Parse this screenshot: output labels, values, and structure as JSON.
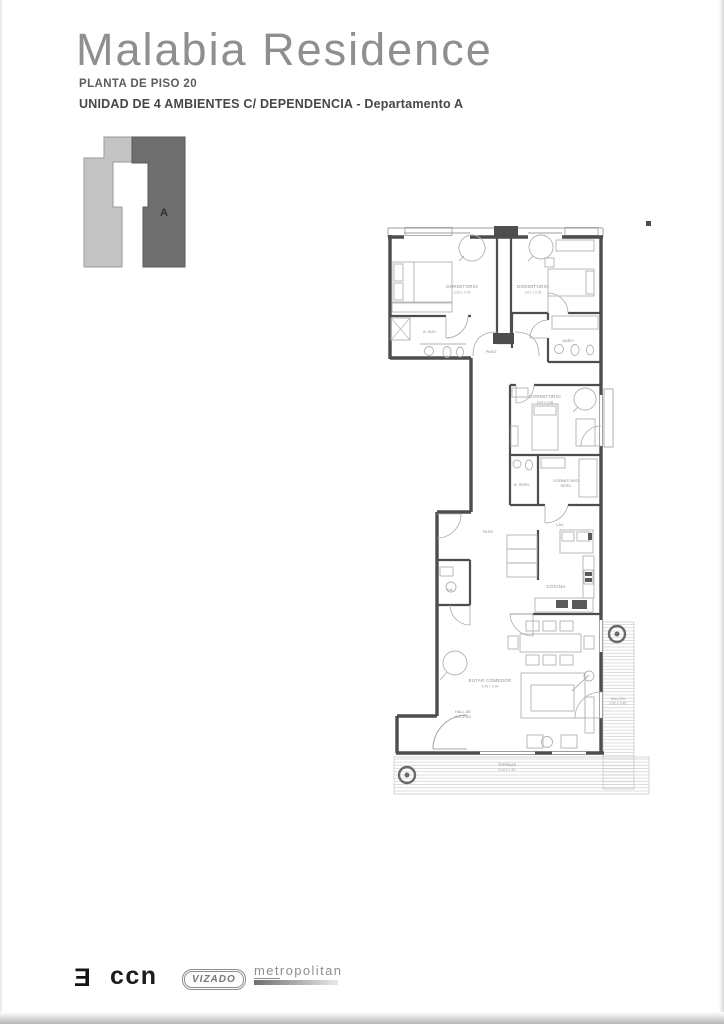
{
  "header": {
    "title": "Malabia Residence",
    "line1": "PLANTA DE PISO 20",
    "line2": "UNIDAD DE 4 AMBIENTES C/ DEPENDENCIA - Departamento A"
  },
  "key_plan": {
    "unit_label": "A",
    "light_color": "#c4c4c4",
    "dark_color": "#6f6f6f"
  },
  "plan": {
    "wall_color": "#4d4d4d",
    "rooms": {
      "dormitorio1": {
        "name": "DORMITORIO",
        "dims": "3.28 x 3.05"
      },
      "dormitorio2": {
        "name": "DORMITORIO",
        "dims": "3.07 x 3.05"
      },
      "bano_aux": {
        "name": "B. AUX."
      },
      "bano": {
        "name": "BAÑO"
      },
      "paso1": {
        "name": "PASO"
      },
      "dormitorio3": {
        "name": "DORMITORIO",
        "dims": "3.04 x 3.56"
      },
      "bano_serv": {
        "name": "B. SERV."
      },
      "dorm_serv": {
        "name": "DORMITORIO",
        "name2": "SERV."
      },
      "paso2": {
        "name": "PASO"
      },
      "toilette": {
        "name": "Toil."
      },
      "lavadero": {
        "name": "LAV."
      },
      "cocina": {
        "name": "COCINA"
      },
      "estar": {
        "name": "ESTAR COMEDOR",
        "dims": "5.48 x 6.90"
      },
      "hall": {
        "name": "HALL DE",
        "name2": "ACCESO"
      },
      "terraza": {
        "name": "TERRAZA",
        "dims": "8.10 x 1.50"
      },
      "balcon": {
        "name": "BALCÓN",
        "dims": "0.90 x 5.45"
      }
    }
  },
  "footer": {
    "logo_mark": "Ǝ",
    "logo_ccn": "ccn",
    "logo_vizado": "VIZADO",
    "logo_metropolitan_prefix": "met",
    "logo_metropolitan_rest": "ropolitan"
  }
}
